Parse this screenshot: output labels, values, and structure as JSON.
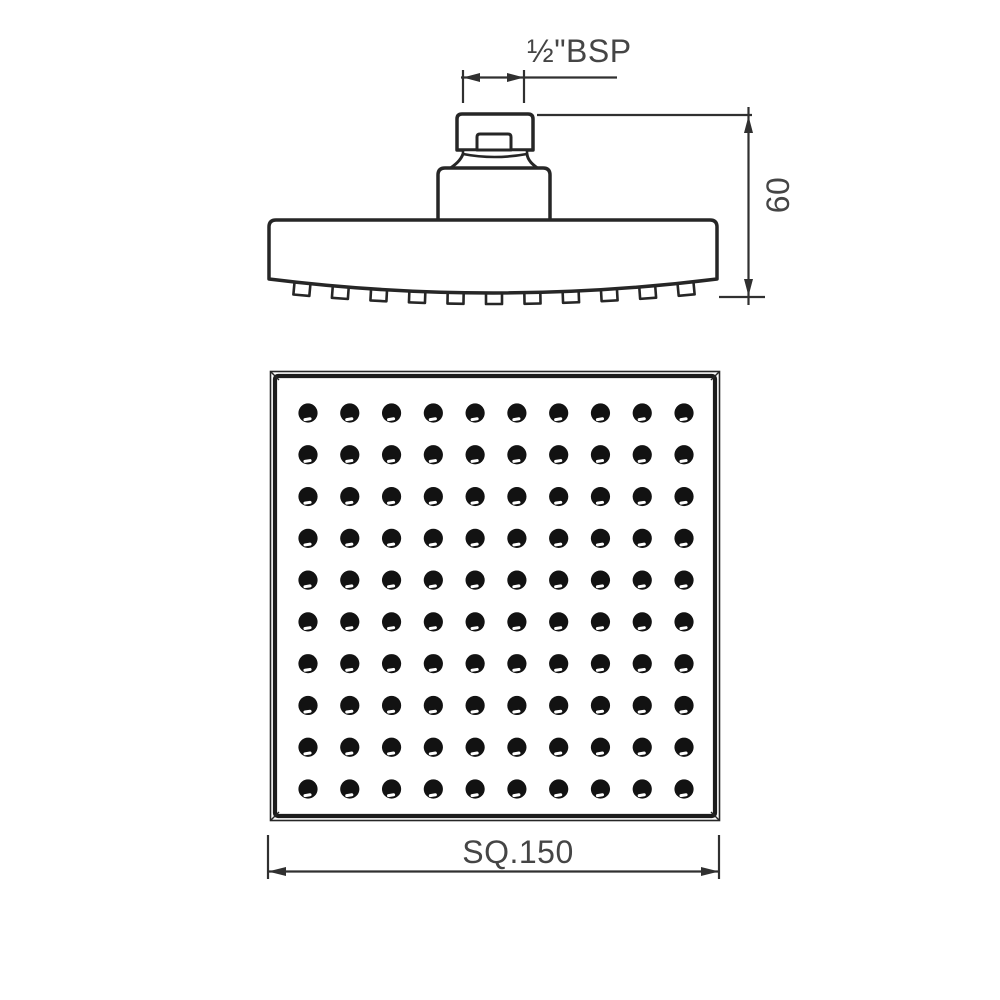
{
  "drawing": {
    "background": "#ffffff",
    "object_line_color": "#262626",
    "dimension_line_color": "#303030",
    "text_color": "#454545",
    "dot_color": "#121212",
    "dimensions": {
      "thread": {
        "label": "½\"BSP"
      },
      "height": {
        "label": "60"
      },
      "face": {
        "label": "SQ.150"
      }
    },
    "side_view": {
      "nozzle_count": 11
    },
    "face_view": {
      "nozzle_grid": {
        "rows": 10,
        "cols": 10,
        "total": 100
      }
    }
  }
}
